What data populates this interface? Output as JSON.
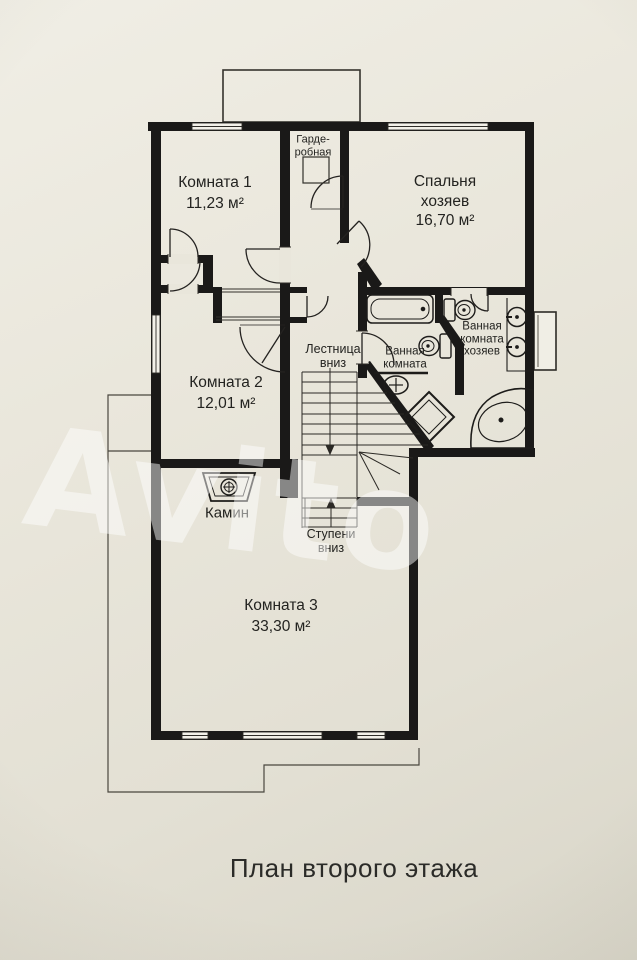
{
  "title": "План второго этажа",
  "watermark": "Avito",
  "rooms": {
    "room1": {
      "name": "Комната 1",
      "area": "11,23 м²"
    },
    "master_bedroom": {
      "line1": "Спальня",
      "line2": "хозяев",
      "area": "16,70 м²"
    },
    "room2": {
      "name": "Комната 2",
      "area": "12,01 м²"
    },
    "room3": {
      "name": "Комната 3",
      "area": "33,30 м²"
    },
    "wardrobe": {
      "line1": "Гарде-",
      "line2": "робная"
    },
    "bathroom": {
      "line1": "Ванная",
      "line2": "комната"
    },
    "master_bathroom": {
      "line1": "Ванная",
      "line2": "комната",
      "line3": "хозяев"
    },
    "stairs": {
      "line1": "Лестница",
      "line2": "вниз"
    },
    "steps": {
      "line1": "Ступени",
      "line2": "вниз"
    },
    "fireplace": {
      "name": "Камин"
    }
  },
  "colors": {
    "paper": "#e9e6db",
    "wall": "#1a1918",
    "thin_line": "#3c3a34",
    "watermark": "#ffffff"
  }
}
